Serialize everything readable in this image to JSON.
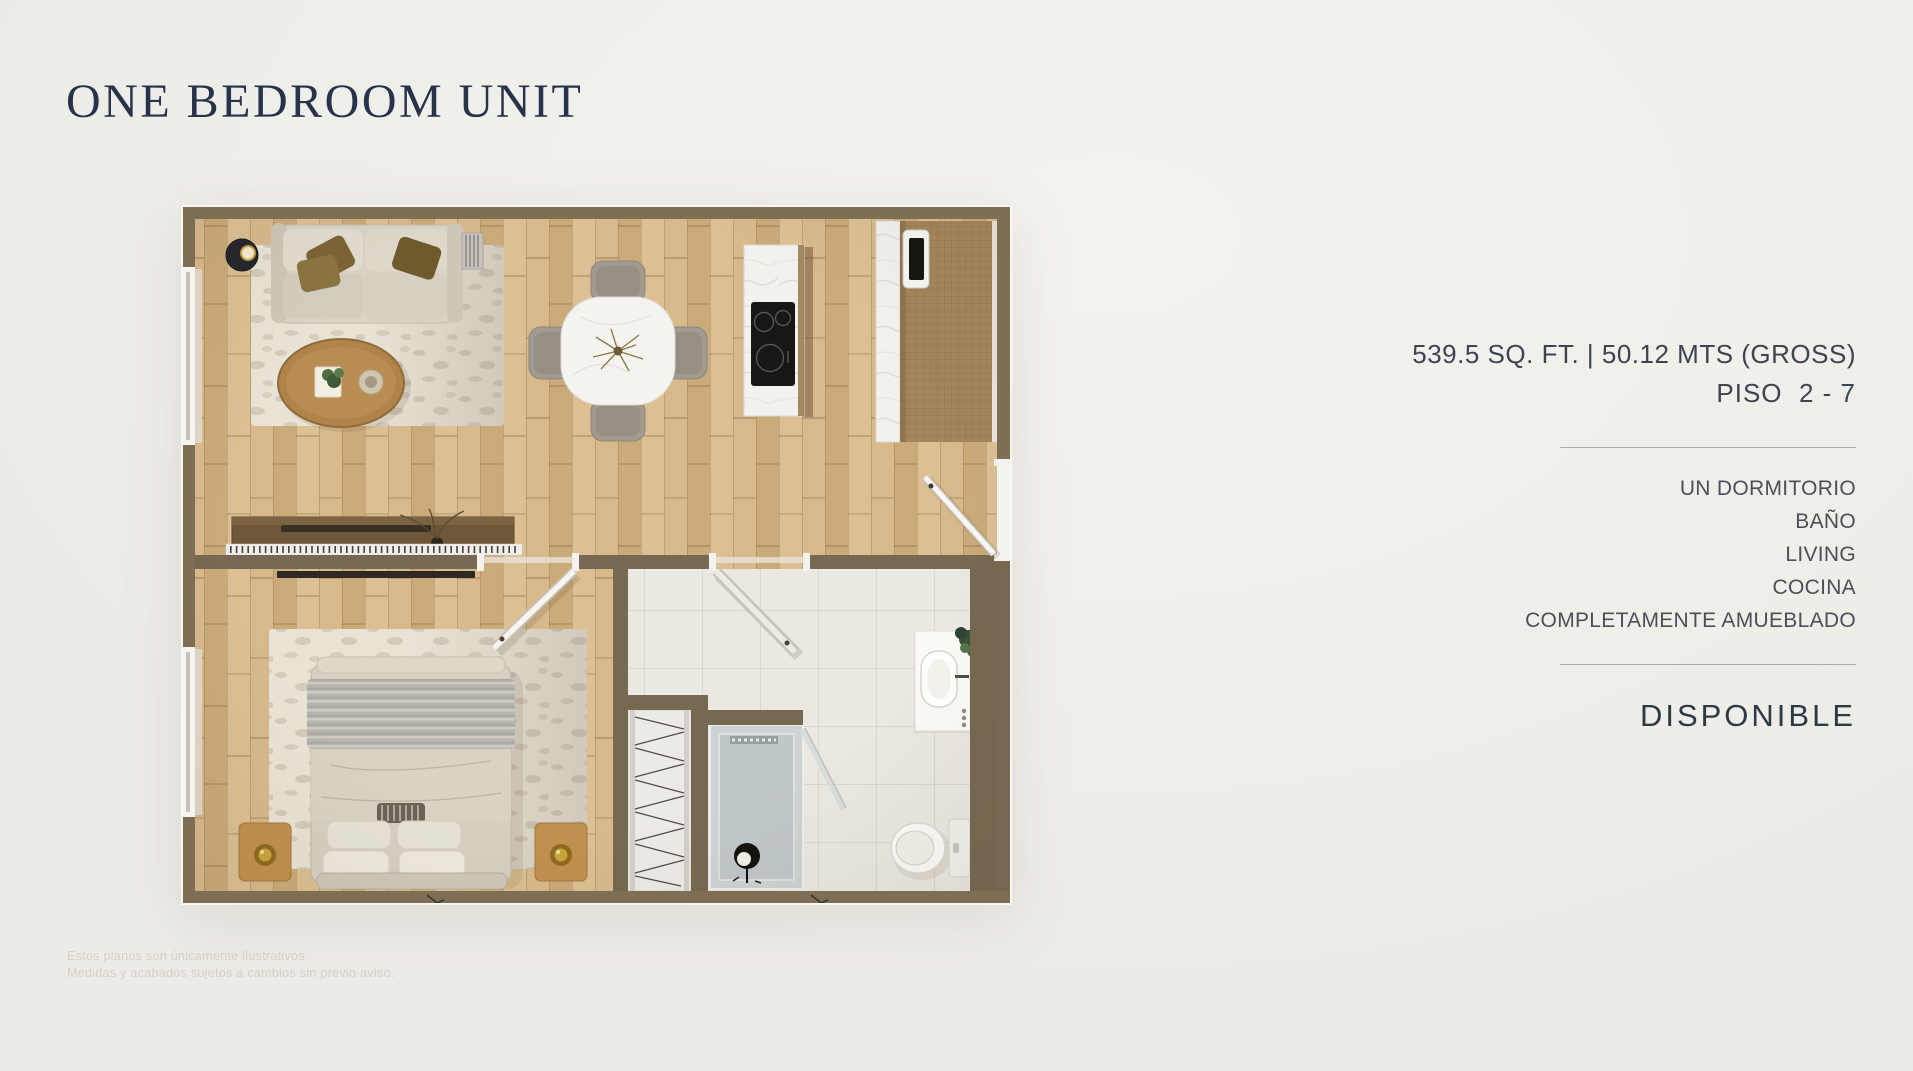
{
  "page": {
    "title": "ONE BEDROOM UNIT"
  },
  "unit_details": {
    "area": "539.5 SQ. FT. | 50.12 MTS (GROSS)",
    "floors": "PISO  2 - 7",
    "features": [
      "UN DORMITORIO",
      "BAÑO",
      "LIVING",
      "COCINA",
      "COMPLETAMENTE AMUEBLADO"
    ],
    "availability": "DISPONIBLE"
  },
  "disclaimer": {
    "line1": "Estos planos son únicamente ilustrativos.",
    "line2": "Medidas y acabados sujetos a cambios sin previo aviso."
  },
  "floor_plan": {
    "type": "one-bedroom-apartment-top-view",
    "rooms": [
      "living",
      "dining",
      "kitchen",
      "bedroom",
      "bathroom",
      "closet"
    ]
  },
  "colors": {
    "background": "#f1efea",
    "title_navy": "#26334a",
    "text_slate": "#454c57",
    "wall_brown": "#7d6e54",
    "wood_floor": "#d2b385",
    "tile": "#ebe8e1",
    "cabinet_wood": "#a4855b"
  }
}
